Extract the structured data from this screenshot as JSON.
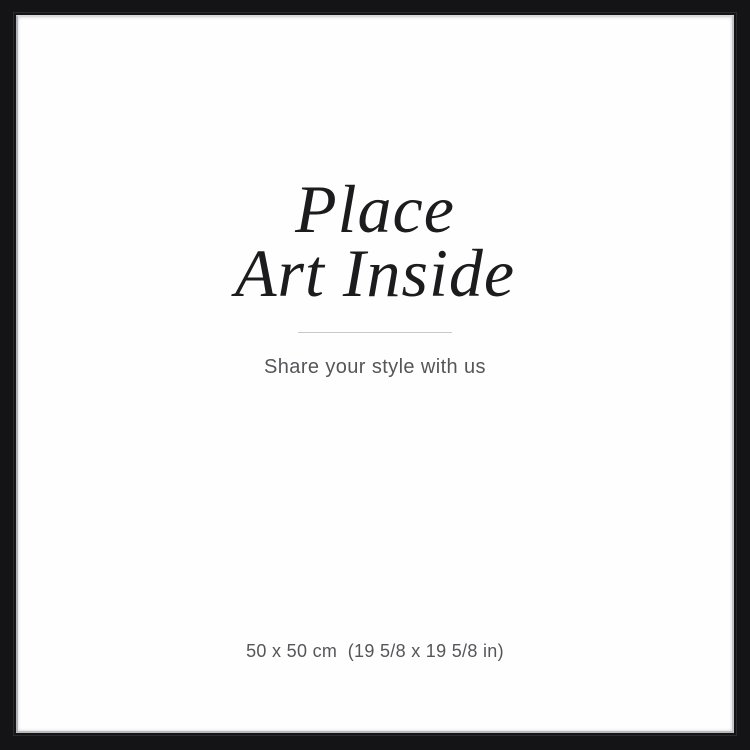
{
  "insert": {
    "heading_line1": "Place",
    "heading_line2": "Art Inside",
    "subtitle": "Share your style with us",
    "size_label": "50 x 50 cm  (19 5/8 x 19 5/8 in)"
  },
  "colors": {
    "frame": "#141417",
    "insert-bg": "#fefefe",
    "heading-text": "#1c1c1e",
    "muted-text": "#56565a",
    "divider": "#c9c9c9"
  }
}
